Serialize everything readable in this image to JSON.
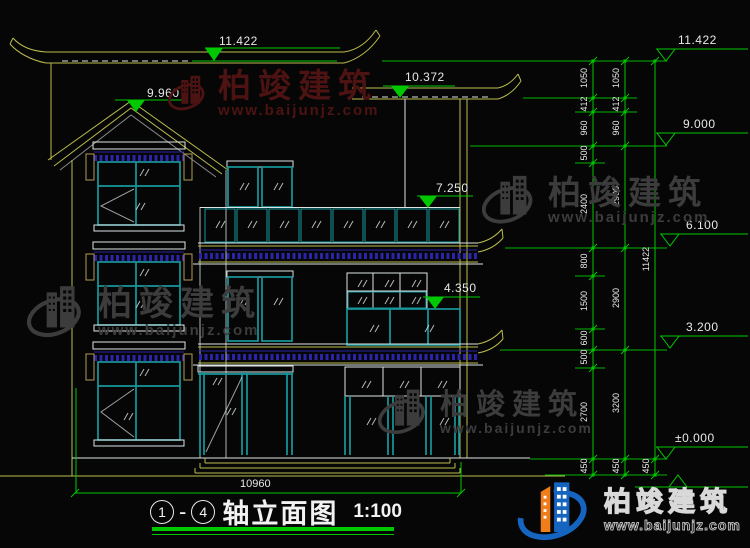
{
  "drawing": {
    "markers_building": [
      {
        "value": "11.422"
      },
      {
        "value": "9.960"
      },
      {
        "value": "10.372"
      },
      {
        "value": "7.250"
      },
      {
        "value": "4.350"
      }
    ],
    "markers_scale": [
      {
        "value": "11.422"
      },
      {
        "value": "9.000"
      },
      {
        "value": "6.100"
      },
      {
        "value": "3.200"
      },
      {
        "value": "±0.000"
      }
    ],
    "dim_chains": {
      "col1": [
        "1050",
        "412",
        "960",
        "500",
        "2400",
        "800",
        "1500",
        "600",
        "500",
        "2700",
        "450"
      ],
      "col2": [
        "1050",
        "412",
        "960",
        "2900",
        "2900",
        "3200",
        "450"
      ],
      "col3": [
        "11422",
        "450"
      ]
    },
    "width_dim": "10960"
  },
  "title_block": {
    "axis_start": "1",
    "separator": "-",
    "axis_end": "4",
    "title": "轴立面图",
    "scale": "1:100"
  },
  "watermark": {
    "brand": "柏竣建筑",
    "url": "www.baijunjz.com"
  },
  "colors": {
    "background": "#060606",
    "line_yellow": "#bcbc4e",
    "line_white": "#dfe4e4",
    "window_teal": "#17989c",
    "tile_blue": "#2b24a8",
    "bracket_tan": "#b49a58",
    "dim_green": "#00c800",
    "text_white": "#e8e8e8",
    "watermark_maroon": "#4d1313",
    "watermark_gray": "#3c3c3c",
    "logo_blue": "#1565c0",
    "logo_orange": "#ef7d1a"
  }
}
